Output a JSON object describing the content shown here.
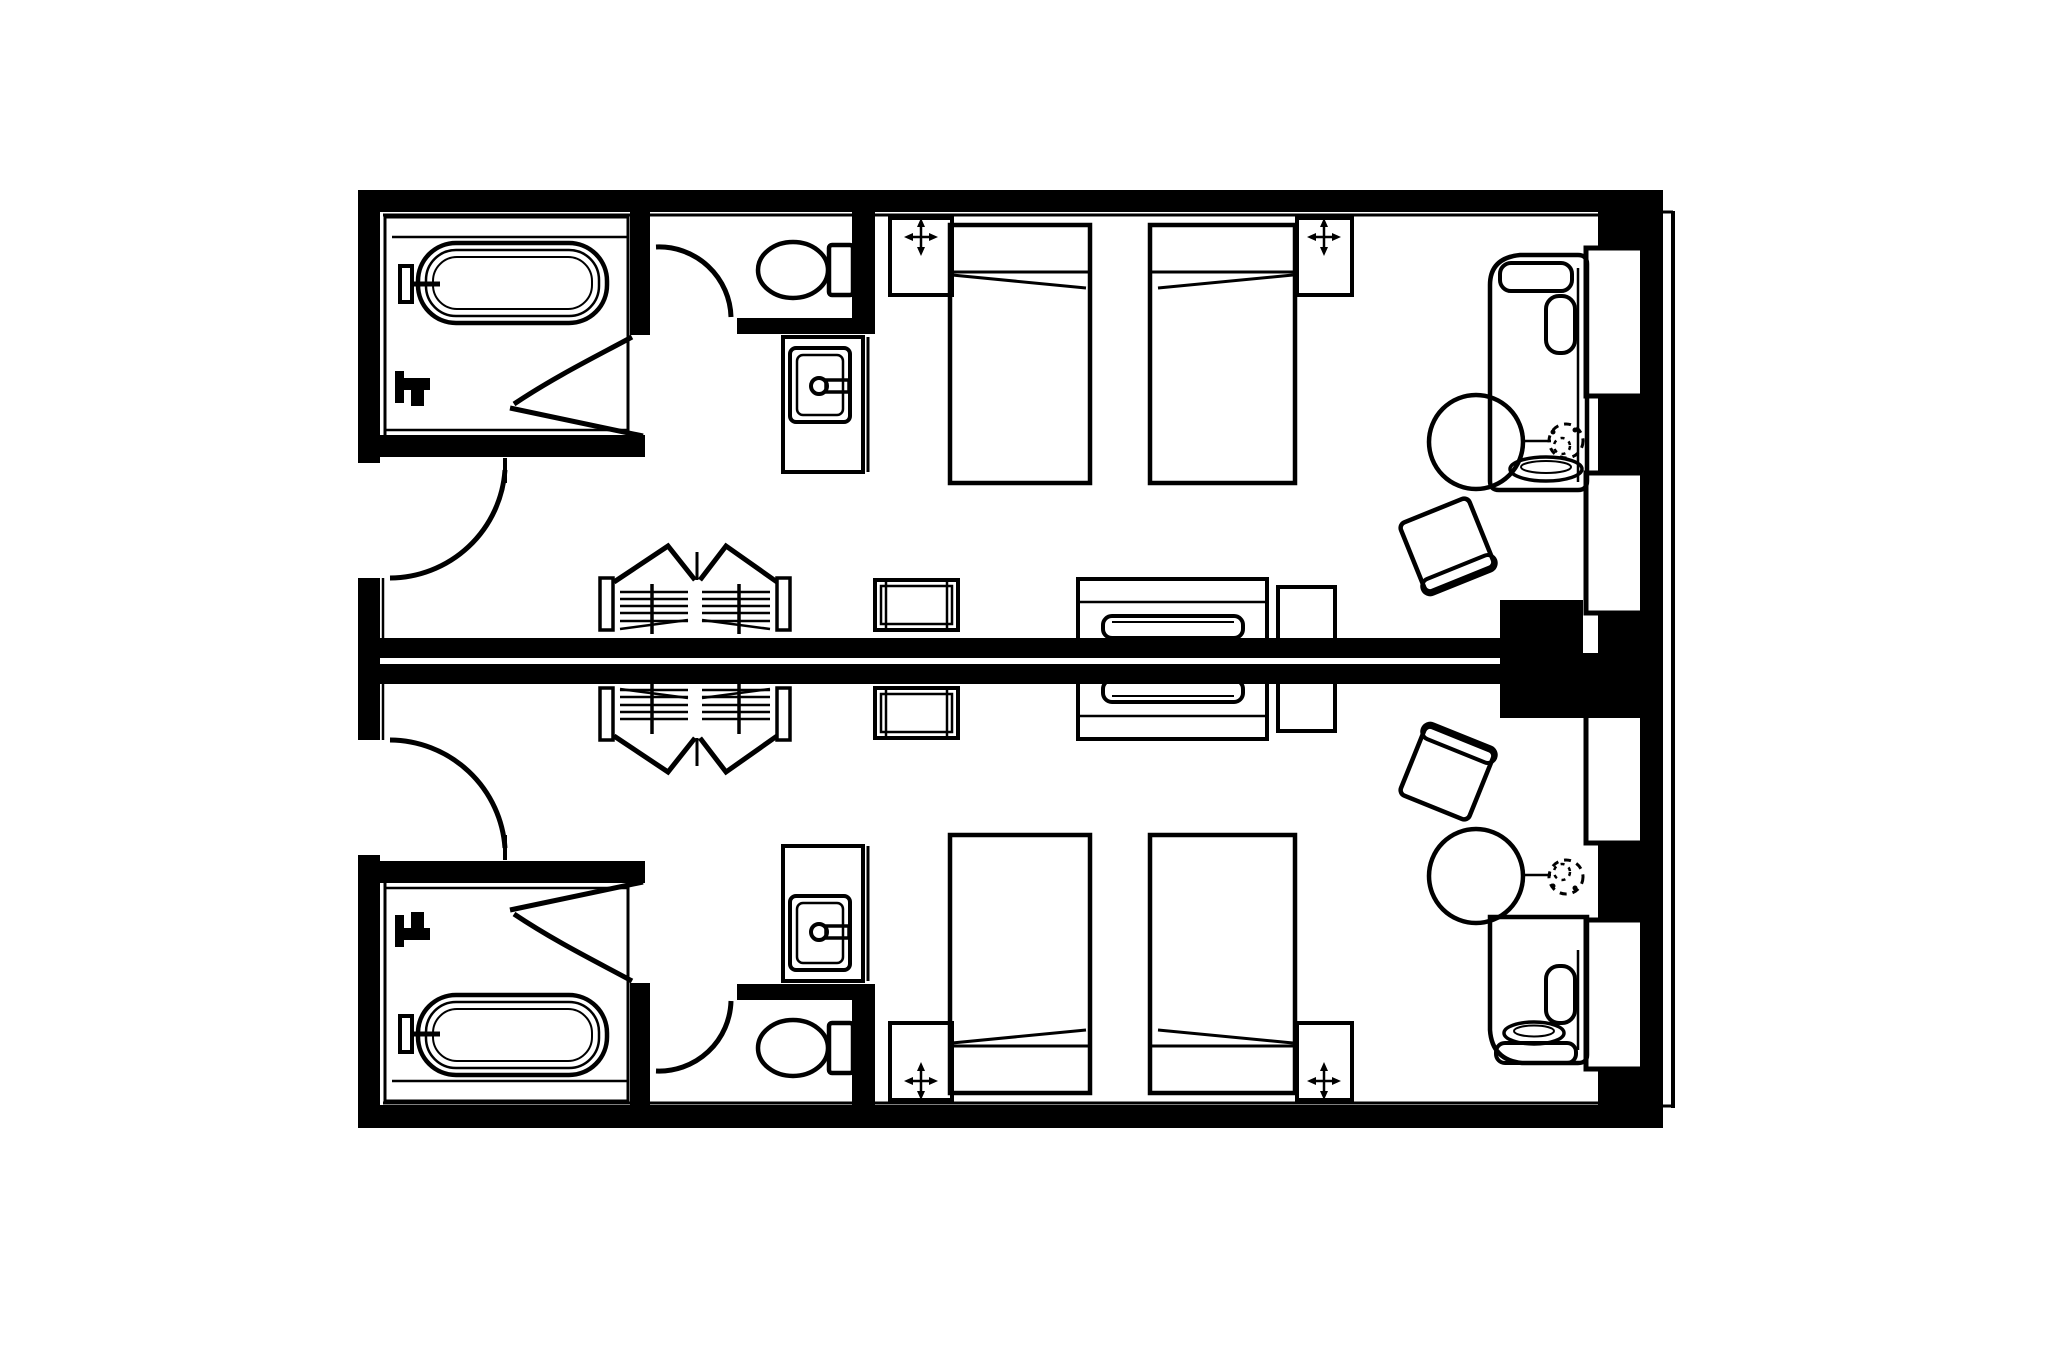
{
  "canvas": {
    "width": 2048,
    "height": 1365,
    "background": "#ffffff",
    "ink": "#000000"
  },
  "plan": {
    "kind": "hotel-twin-guestroom-floor-plan",
    "rooms": [
      {
        "id": "guestroom-upper",
        "label": "guestroom-upper",
        "furniture": [
          "bathtub",
          "tub-spout",
          "shower-valve",
          "toilet",
          "vanity-sink",
          "sink-faucet",
          "entry-door",
          "bathroom-door",
          "toilet-door",
          "closet-bifold-doors",
          "clothes-hangers",
          "luggage-rack",
          "twin-bed-1",
          "twin-bed-2",
          "nightstand-left",
          "nightstand-right",
          "ceiling-light-left",
          "ceiling-light-right",
          "tv-console",
          "television",
          "side-cabinet",
          "armchair",
          "round-table",
          "potted-plant",
          "chaise-lounge",
          "bolster-cushion",
          "oval-tray",
          "window-1",
          "window-2"
        ]
      },
      {
        "id": "guestroom-lower",
        "label": "guestroom-lower",
        "furniture": [
          "bathtub",
          "tub-spout",
          "shower-valve",
          "toilet",
          "vanity-sink",
          "sink-faucet",
          "entry-door",
          "bathroom-door",
          "toilet-door",
          "closet-bifold-doors",
          "clothes-hangers",
          "luggage-rack",
          "twin-bed-1",
          "twin-bed-2",
          "nightstand-left",
          "nightstand-right",
          "ceiling-light-left",
          "ceiling-light-right",
          "tv-console",
          "television",
          "side-cabinet",
          "armchair",
          "round-table",
          "potted-plant",
          "chaise-lounge",
          "bolster-cushion",
          "oval-tray",
          "window-1",
          "window-2"
        ]
      }
    ]
  }
}
